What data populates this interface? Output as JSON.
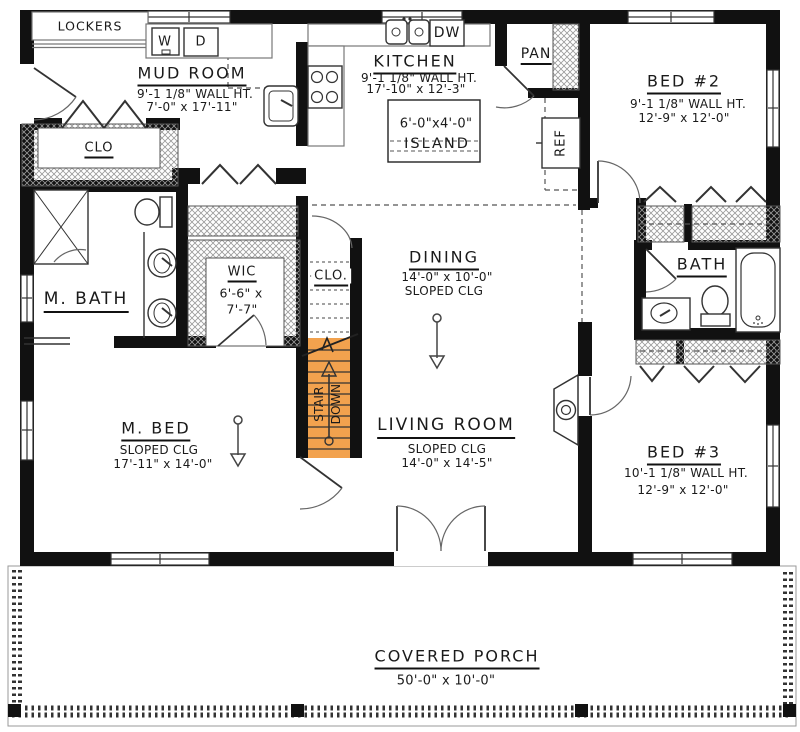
{
  "plan": {
    "rooms": {
      "mud_room": {
        "name": "MUD ROOM",
        "wall_ht": "9'-1 1/8\" WALL HT.",
        "dims": "7'-0\" x 17'-11\""
      },
      "kitchen": {
        "name": "KITCHEN",
        "wall_ht": "9'-1 1/8\" WALL HT.",
        "dims": "17'-10\" x 12'-3\""
      },
      "bed2": {
        "name": "BED #2",
        "wall_ht": "9'-1 1/8\" WALL HT.",
        "dims": "12'-9\" x 12'-0\""
      },
      "dining": {
        "name": "DINING",
        "dims": "14'-0\" x 10'-0\"",
        "ceiling": "SLOPED CLG"
      },
      "living": {
        "name": "LIVING ROOM",
        "ceiling": "SLOPED CLG",
        "dims": "14'-0\" x 14'-5\""
      },
      "m_bed": {
        "name": "M. BED",
        "ceiling": "SLOPED CLG",
        "dims": "17'-11\" x 14'-0\""
      },
      "m_bath": {
        "name": "M. BATH"
      },
      "wic": {
        "name": "WIC",
        "dims_l1": "6'-6\" x",
        "dims_l2": "7'-7\""
      },
      "bath": {
        "name": "BATH"
      },
      "bed3": {
        "name": "BED #3",
        "wall_ht": "10'-1 1/8\" WALL HT.",
        "dims": "12'-9\" x 12'-0\""
      },
      "porch": {
        "name": "COVERED PORCH",
        "dims": "50'-0\" x 10'-0\""
      }
    },
    "features": {
      "lockers": "LOCKERS",
      "washer": "W",
      "dryer": "D",
      "dishwasher": "DW",
      "pantry": "PAN",
      "fridge": "REF",
      "closet_mud": "CLO",
      "closet_stair": "CLO.",
      "island_l1": "6'-0\"x4'-0\"",
      "island_l2": "ISLAND",
      "stair_l1": "STAIR",
      "stair_l2": "DOWN"
    },
    "colors": {
      "wall": "#111111",
      "stairs": "#F2A24E"
    }
  }
}
